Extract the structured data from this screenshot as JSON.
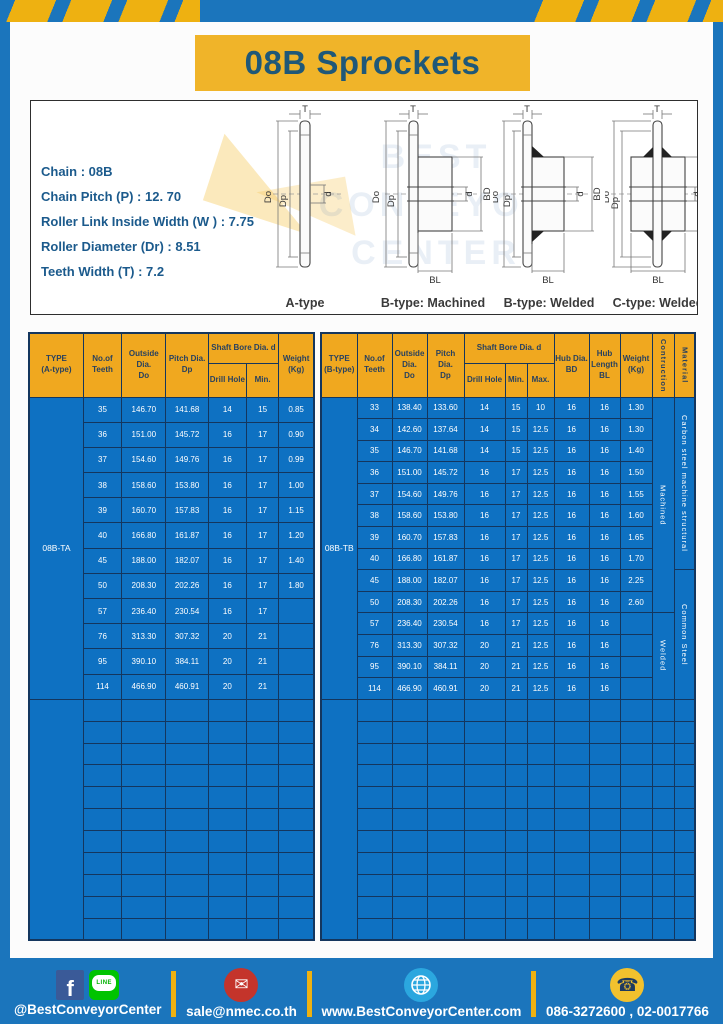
{
  "title": "08B Sprockets",
  "specs": {
    "lines": [
      "Chain  : 08B",
      "Chain Pitch (P)  :  12. 70",
      "Roller Link Inside Width (W )  :  7.75",
      "Roller Diameter (Dr)  : 8.51",
      "Teeth Width (T)  :  7.2"
    ]
  },
  "diagrams": {
    "labels": {
      "t": "T",
      "do": "Do",
      "dp": "Dp",
      "d": "d",
      "bd": "BD",
      "bl": "BL"
    },
    "captions": [
      "A-type",
      "B-type: Machined",
      "B-type: Welded",
      "C-type: Welded"
    ],
    "watermark": "BEST\nCONVEYOR\nCENTER"
  },
  "table_a": {
    "headers": {
      "type": "TYPE\n(A-type)",
      "teeth": "No.of\nTeeth",
      "outside": "Outside\nDia.\nDo",
      "pitch": "Pitch Dia.\nDp",
      "shaft_bore": "Shaft Bore Dia. d",
      "drill_hole": "Drill Hole",
      "min": "Min.",
      "weight": "Weight\n(Kg)"
    },
    "type_value": "08B-TA",
    "rows": [
      [
        "35",
        "146.70",
        "141.68",
        "14",
        "15",
        "0.85"
      ],
      [
        "36",
        "151.00",
        "145.72",
        "16",
        "17",
        "0.90"
      ],
      [
        "37",
        "154.60",
        "149.76",
        "16",
        "17",
        "0.99"
      ],
      [
        "38",
        "158.60",
        "153.80",
        "16",
        "17",
        "1.00"
      ],
      [
        "39",
        "160.70",
        "157.83",
        "16",
        "17",
        "1.15"
      ],
      [
        "40",
        "166.80",
        "161.87",
        "16",
        "17",
        "1.20"
      ],
      [
        "45",
        "188.00",
        "182.07",
        "16",
        "17",
        "1.40"
      ],
      [
        "50",
        "208.30",
        "202.26",
        "16",
        "17",
        "1.80"
      ],
      [
        "57",
        "236.40",
        "230.54",
        "16",
        "17",
        ""
      ],
      [
        "76",
        "313.30",
        "307.32",
        "20",
        "21",
        ""
      ],
      [
        "95",
        "390.10",
        "384.11",
        "20",
        "21",
        ""
      ],
      [
        "114",
        "466.90",
        "460.91",
        "20",
        "21",
        ""
      ]
    ],
    "empty_rows": 11
  },
  "table_b": {
    "headers": {
      "type": "TYPE\n(B-type)",
      "teeth": "No.of\nTeeth",
      "outside": "Outside\nDia.\nDo",
      "pitch": "Pitch Dia.\nDp",
      "shaft_bore": "Shaft Bore Dia. d",
      "drill_hole": "Drill Hole",
      "min": "Min.",
      "max": "Max.",
      "hub_dia": "Hub Dia.\nBD",
      "hub_length": "Hub\nLength\nBL",
      "weight": "Weight\n(Kg)",
      "construction": "Contruction",
      "material": "Material"
    },
    "type_value": "08B-TB",
    "rows": [
      [
        "33",
        "138.40",
        "133.60",
        "14",
        "15",
        "10",
        "16",
        "16",
        "1.30"
      ],
      [
        "34",
        "142.60",
        "137.64",
        "14",
        "15",
        "12.5",
        "16",
        "16",
        "1.30"
      ],
      [
        "35",
        "146.70",
        "141.68",
        "14",
        "15",
        "12.5",
        "16",
        "16",
        "1.40"
      ],
      [
        "36",
        "151.00",
        "145.72",
        "16",
        "17",
        "12.5",
        "16",
        "16",
        "1.50"
      ],
      [
        "37",
        "154.60",
        "149.76",
        "16",
        "17",
        "12.5",
        "16",
        "16",
        "1.55"
      ],
      [
        "38",
        "158.60",
        "153.80",
        "16",
        "17",
        "12.5",
        "16",
        "16",
        "1.60"
      ],
      [
        "39",
        "160.70",
        "157.83",
        "16",
        "17",
        "12.5",
        "16",
        "16",
        "1.65"
      ],
      [
        "40",
        "166.80",
        "161.87",
        "16",
        "17",
        "12.5",
        "16",
        "16",
        "1.70"
      ],
      [
        "45",
        "188.00",
        "182.07",
        "16",
        "17",
        "12.5",
        "16",
        "16",
        "2.25"
      ],
      [
        "50",
        "208.30",
        "202.26",
        "16",
        "17",
        "12.5",
        "16",
        "16",
        "2.60"
      ],
      [
        "57",
        "236.40",
        "230.54",
        "16",
        "17",
        "12.5",
        "16",
        "16",
        ""
      ],
      [
        "76",
        "313.30",
        "307.32",
        "20",
        "21",
        "12.5",
        "16",
        "16",
        ""
      ],
      [
        "95",
        "390.10",
        "384.11",
        "20",
        "21",
        "12.5",
        "16",
        "16",
        ""
      ],
      [
        "114",
        "466.90",
        "460.91",
        "20",
        "21",
        "12.5",
        "16",
        "16",
        ""
      ]
    ],
    "construction": [
      {
        "label": "Machined",
        "span": 10
      },
      {
        "label": "Welded",
        "span": 4
      }
    ],
    "material": [
      {
        "label": "Carbon steel  machine structural",
        "span": 8
      },
      {
        "label": "Common  Steel",
        "span": 6
      }
    ],
    "empty_rows": 11
  },
  "footer": {
    "social_handle": "@BestConveyorCenter",
    "email": "sale@nmec.co.th",
    "website": "www.BestConveyorCenter.com",
    "phone": "086-3272600 , 02-0017766",
    "line_label": "LINE",
    "facebook_letter": "f"
  },
  "colors": {
    "frame_blue": "#1b75bc",
    "stripe_yellow": "#eeb111",
    "banner_yellow": "#f0b429",
    "title_text": "#1f5878",
    "table_header_bg": "#f0a81f",
    "table_header_text": "#28415f",
    "table_body_bg": "#0e71c2",
    "table_border": "#14365e",
    "spec_text": "#1b5a8c"
  }
}
